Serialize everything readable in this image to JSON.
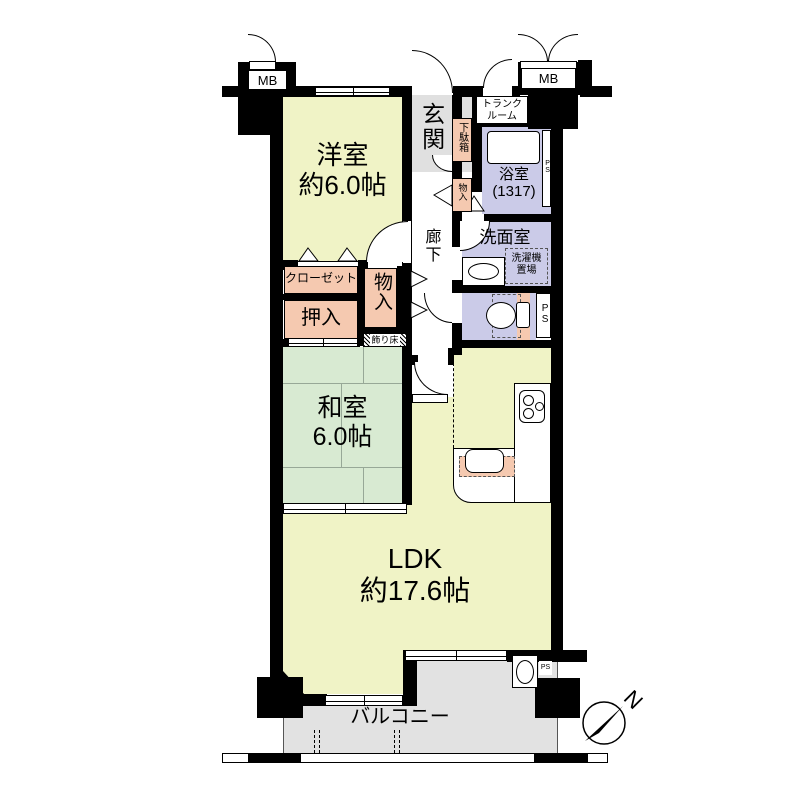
{
  "rooms": {
    "western_room": {
      "line1": "洋室",
      "line2": "約6.0帖"
    },
    "entrance": {
      "label": "玄関"
    },
    "shoe_cabinet": {
      "label": "下駄箱"
    },
    "trunk_room": {
      "line1": "トランク",
      "line2": "ルーム"
    },
    "bathroom": {
      "line1": "浴室",
      "line2": "(1317)"
    },
    "washroom": {
      "label": "洗面室"
    },
    "laundry_space": {
      "line1": "洗濯機",
      "line2": "置場"
    },
    "hallway": {
      "label": "廊下"
    },
    "storage_upper": {
      "label": "物入"
    },
    "closet": {
      "label": "クローゼット"
    },
    "oshiire": {
      "label": "押入"
    },
    "storage_lower": {
      "label": "物入"
    },
    "tokonoma": {
      "label": "飾り床"
    },
    "japanese_room": {
      "line1": "和室",
      "line2": "6.0帖"
    },
    "ldk": {
      "line1": "LDK",
      "line2": "約17.6帖"
    },
    "balcony": {
      "label": "バルコニー"
    }
  },
  "labels": {
    "mb_left": "MB",
    "mb_right": "MB",
    "ps_bathroom": "PS",
    "ps_toilet": "PS",
    "ps_balcony": "PS",
    "compass_north": "N"
  },
  "palette": {
    "room_yellow": "#F0F3C6",
    "tatami_green": "#D8EAD2",
    "wet_lavender": "#CBCBE8",
    "storage_pink": "#F5C9B0",
    "entrance_gray": "#E0E0E0",
    "balcony_gray": "#E2E2E2",
    "wall_black": "#000000"
  }
}
